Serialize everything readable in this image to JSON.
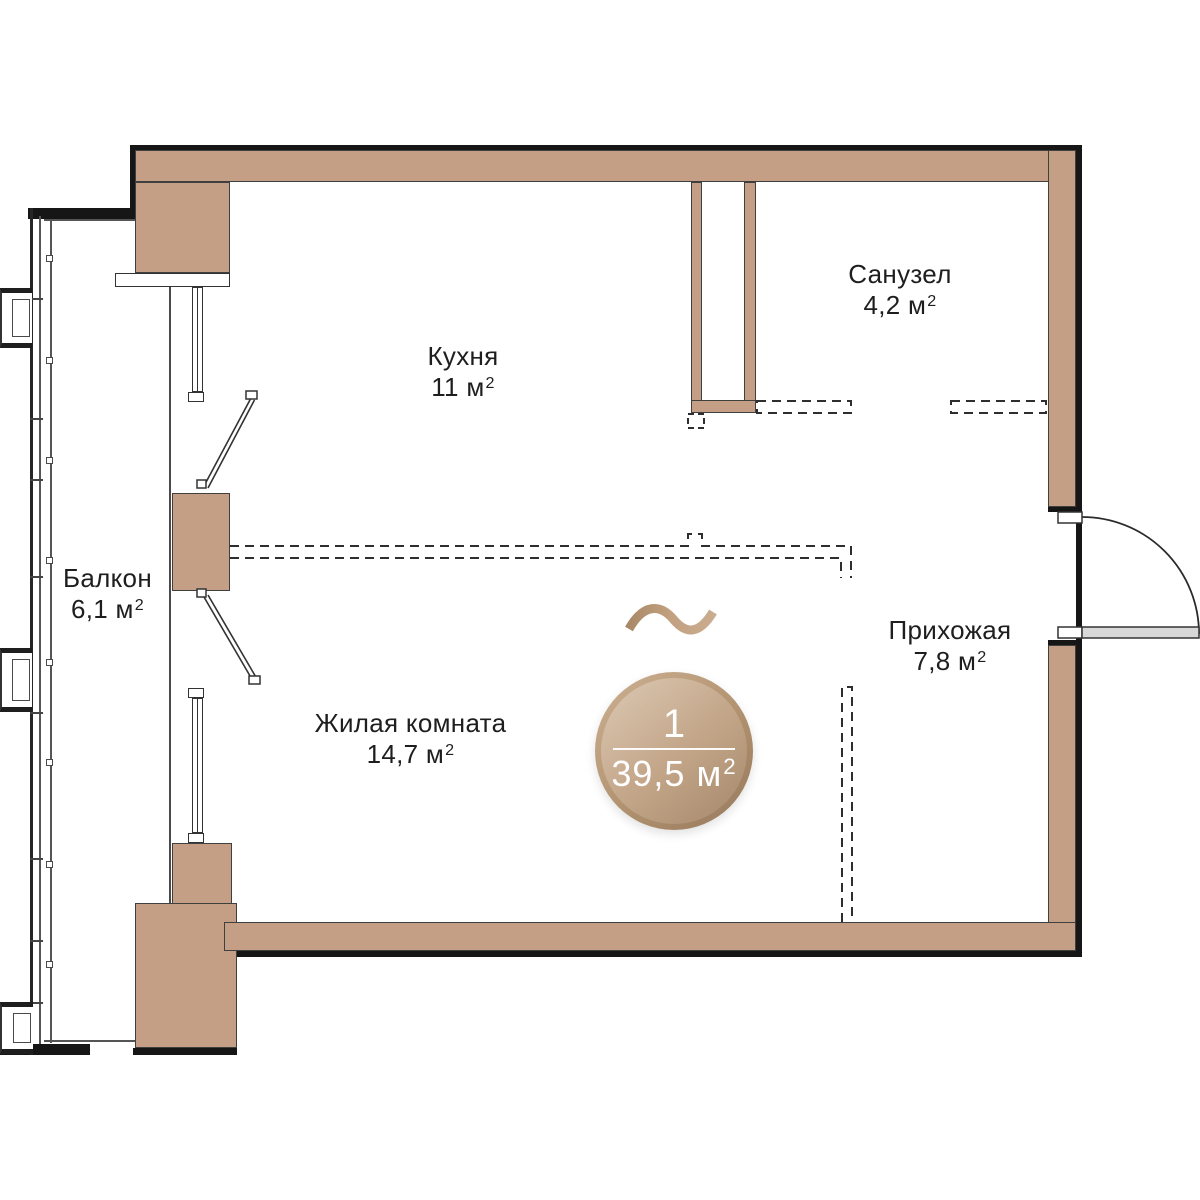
{
  "badge": {
    "count": "1",
    "area": "39,5 м",
    "sup": "2"
  },
  "rooms": [
    {
      "id": "kitchen",
      "name": "Кухня",
      "area": "11 м",
      "sup": "2"
    },
    {
      "id": "bathroom",
      "name": "Санузел",
      "area": "4,2 м",
      "sup": "2"
    },
    {
      "id": "balcony",
      "name": "Балкон",
      "area": "6,1 м",
      "sup": "2"
    },
    {
      "id": "hallway",
      "name": "Прихожая",
      "area": "7,8 м",
      "sup": "2"
    },
    {
      "id": "living",
      "name": "Жилая комната",
      "area": "14,7 м",
      "sup": "2"
    }
  ],
  "colors": {
    "wall": "#c49e85",
    "outline": "#161616",
    "badge_light": "#dbc8b3",
    "badge_dark": "#a5886b",
    "door_leaf": "#d8d8d8"
  }
}
